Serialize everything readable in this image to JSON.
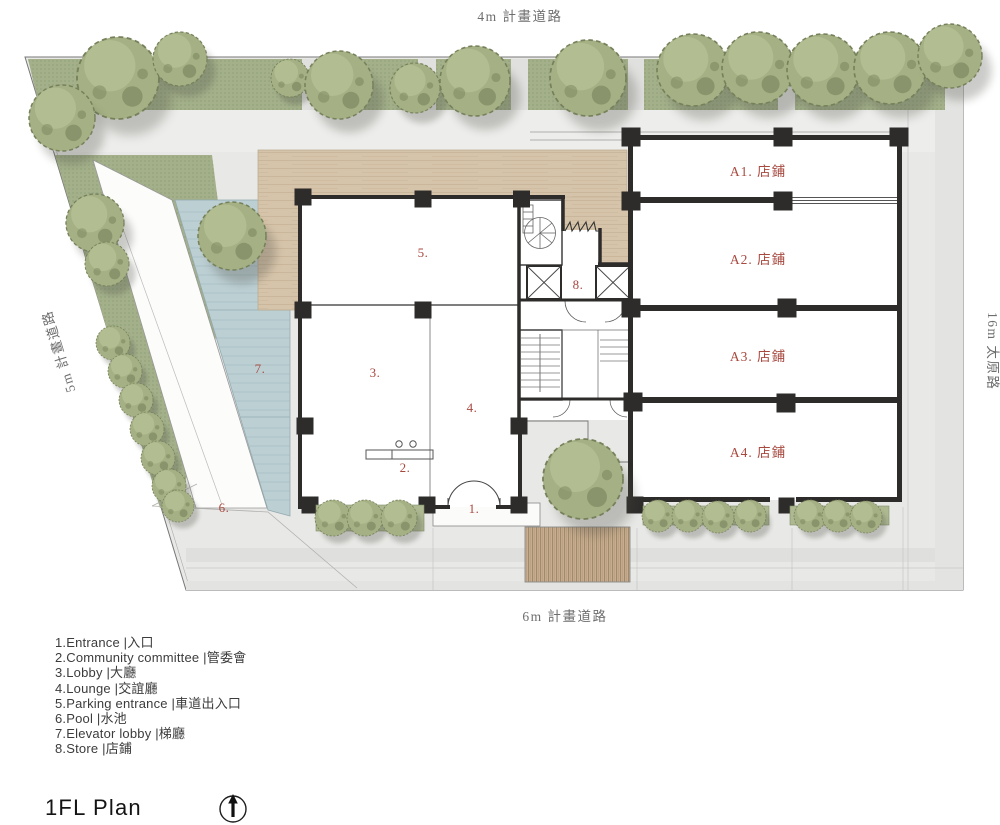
{
  "roads": {
    "top": "4m 計畫道路",
    "bottom": "6m 計畫道路",
    "left": "5m 計畫道路",
    "right": "16m 太原路"
  },
  "plan": {
    "store_units": [
      "A1. 店鋪",
      "A2. 店鋪",
      "A3. 店鋪",
      "A4. 店鋪"
    ],
    "room_numbers": [
      "1.",
      "2.",
      "3.",
      "4.",
      "5.",
      "6.",
      "7.",
      "8."
    ]
  },
  "legend": {
    "items": [
      "1.Entrance |入口",
      "2.Community committee |管委會",
      "3.Lobby |大廳",
      "4.Lounge |交誼廳",
      "5.Parking entrance |車道出入口",
      "6.Pool |水池",
      "7.Elevator lobby |梯廳",
      "8.Store |店鋪"
    ]
  },
  "title": "1FL Plan",
  "icons": {
    "north_arrow": "north-arrow"
  },
  "colors": {
    "site_paving": "#e8e8e6",
    "lawn": "#a3b08a",
    "tree": "#a9b489",
    "pool": "#bccfd3",
    "drive_wood": "#d6c4aa",
    "deck_wood": "#c8ae90",
    "wall": "#2e2c2a",
    "label_red": "#a8493f"
  }
}
